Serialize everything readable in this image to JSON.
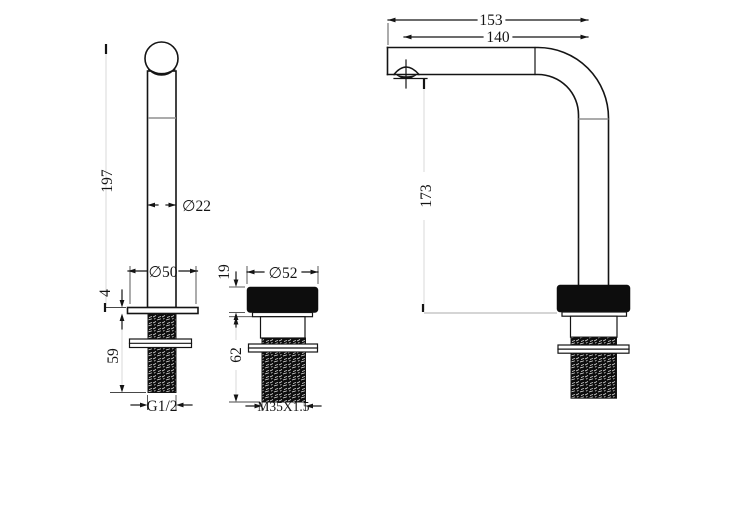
{
  "colors": {
    "line": "#141414",
    "extension_line": "#474747",
    "faint_dim_line": "#d9d9d9",
    "joint_line": "#8f8f8f",
    "thread_fill": "#0d0d0d",
    "background": "#ffffff"
  },
  "drawing": {
    "left_view": {
      "height": "197",
      "body_diameter": "∅22",
      "base_diameter": "∅50",
      "flange_thickness": "4",
      "shank_length": "59",
      "thread": "G1/2"
    },
    "middle_view": {
      "cap_height": "19",
      "cap_diameter": "∅52",
      "body_length": "62",
      "thread": "M35X1.5"
    },
    "right_view": {
      "overall_reach": "153",
      "outlet_reach": "140",
      "outlet_height": "173"
    }
  }
}
